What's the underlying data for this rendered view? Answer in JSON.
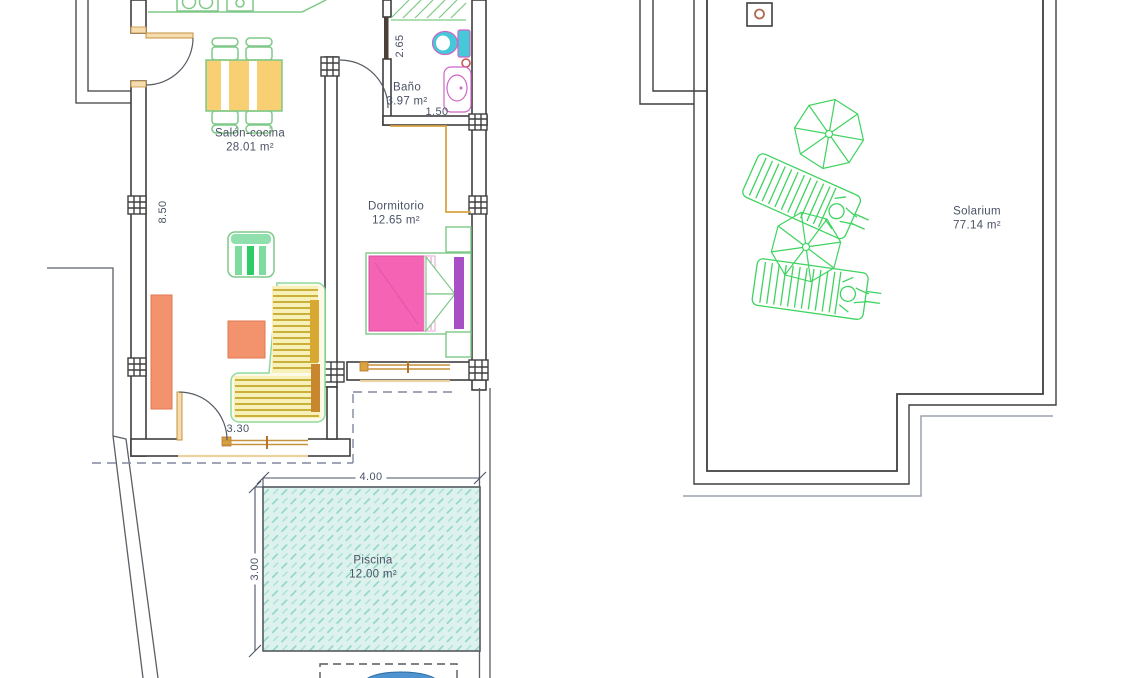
{
  "document": {
    "type": "architectural-floor-plan"
  },
  "rooms": {
    "salon": {
      "name": "Salón-cocina",
      "area": "28.01 m²"
    },
    "bathroom": {
      "name": "Baño",
      "area": "3.97 m²"
    },
    "bedroom": {
      "name": "Dormitorio",
      "area": "12.65 m²"
    },
    "pool": {
      "name": "Piscina",
      "area": "12.00 m²"
    },
    "solarium": {
      "name": "Solarium",
      "area": "77.14 m²"
    }
  },
  "dimensions": {
    "salon_wall_length": "8.50",
    "bathroom_depth": "2.65",
    "bathroom_width": "1.50",
    "salon_opening": "3.30",
    "pool_width": "4.00",
    "pool_depth": "3.00"
  },
  "colors": {
    "wall": "#3f3f3f",
    "boundary_gray": "#9aa3b0",
    "dashed_boundary": "#8089a0",
    "label_text": "#4a5264",
    "furniture_green": "#7ec987",
    "bright_green": "#3fd35f",
    "table_yellow": "#f8cf72",
    "sofa_cushion": "#f7f0b8",
    "slat_olive": "#c8b03a",
    "armrest_gold": "#d9a832",
    "armrest_brown": "#c8862f",
    "salmon": "#f2936e",
    "bed_pink": "#f463b4",
    "headboard_purple": "#a94fc6",
    "fixture_magenta": "#cc66c4",
    "toilet_cyan": "#45c8d8",
    "frame_orange": "#c8913c",
    "frame_tan": "#f5ddb0",
    "pool_fill": "#ddf2ec",
    "pool_hatch": "#8fd5c8",
    "vent_red": "#b06a52",
    "water_blue": "#4f93d0"
  }
}
